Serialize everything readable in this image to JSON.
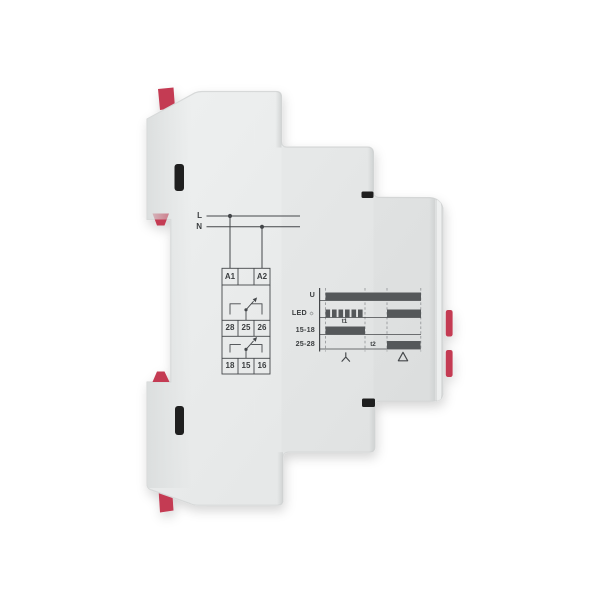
{
  "colors": {
    "background": "#ffffff",
    "device_body": "#e9ebeb",
    "device_shading": "#d8dada",
    "clip_red": "#c43a52",
    "vent_slot": "#1f1f1f",
    "diagram_line": "#44474a",
    "diagram_bar": "#55585a",
    "diagram_text": "#3b3e40"
  },
  "wiring_diagram": {
    "line_labels": {
      "live": "L",
      "neutral": "N"
    },
    "supply_terminals": [
      "A1",
      "A2"
    ],
    "relay1_terminals": [
      "28",
      "25",
      "26"
    ],
    "relay2_terminals": [
      "18",
      "15",
      "16"
    ]
  },
  "timing_diagram": {
    "axis_x": 319.6,
    "right_x": 421,
    "top_y": 288,
    "bottom_y": 351.5,
    "bar_height": 8,
    "phase_boundaries_x": [
      325.5,
      365,
      387,
      420.8
    ],
    "led_icon": "☼",
    "rows": [
      {
        "label": "U",
        "baseline_y": 300.5,
        "bars": [
          {
            "from": 325.5,
            "to": 421,
            "style": "solid"
          }
        ]
      },
      {
        "label": "LED",
        "baseline_y": 317.5,
        "bars": [
          {
            "from": 325.5,
            "to": 362.6,
            "style": "blink",
            "count": 6
          },
          {
            "from": 387,
            "to": 421,
            "style": "solid"
          }
        ]
      },
      {
        "label": "15-18",
        "baseline_y": 334.5,
        "bars": [
          {
            "from": 325.5,
            "to": 365,
            "style": "solid"
          }
        ],
        "annotation": "t1"
      },
      {
        "label": "25-28",
        "baseline_y": 349,
        "bars": [
          {
            "from": 387,
            "to": 420.5,
            "style": "solid"
          }
        ],
        "annotation": "t2"
      }
    ],
    "phases": [
      {
        "symbol": "star",
        "center_x": 345.8
      },
      {
        "symbol": "delta",
        "center_x": 403
      }
    ]
  }
}
